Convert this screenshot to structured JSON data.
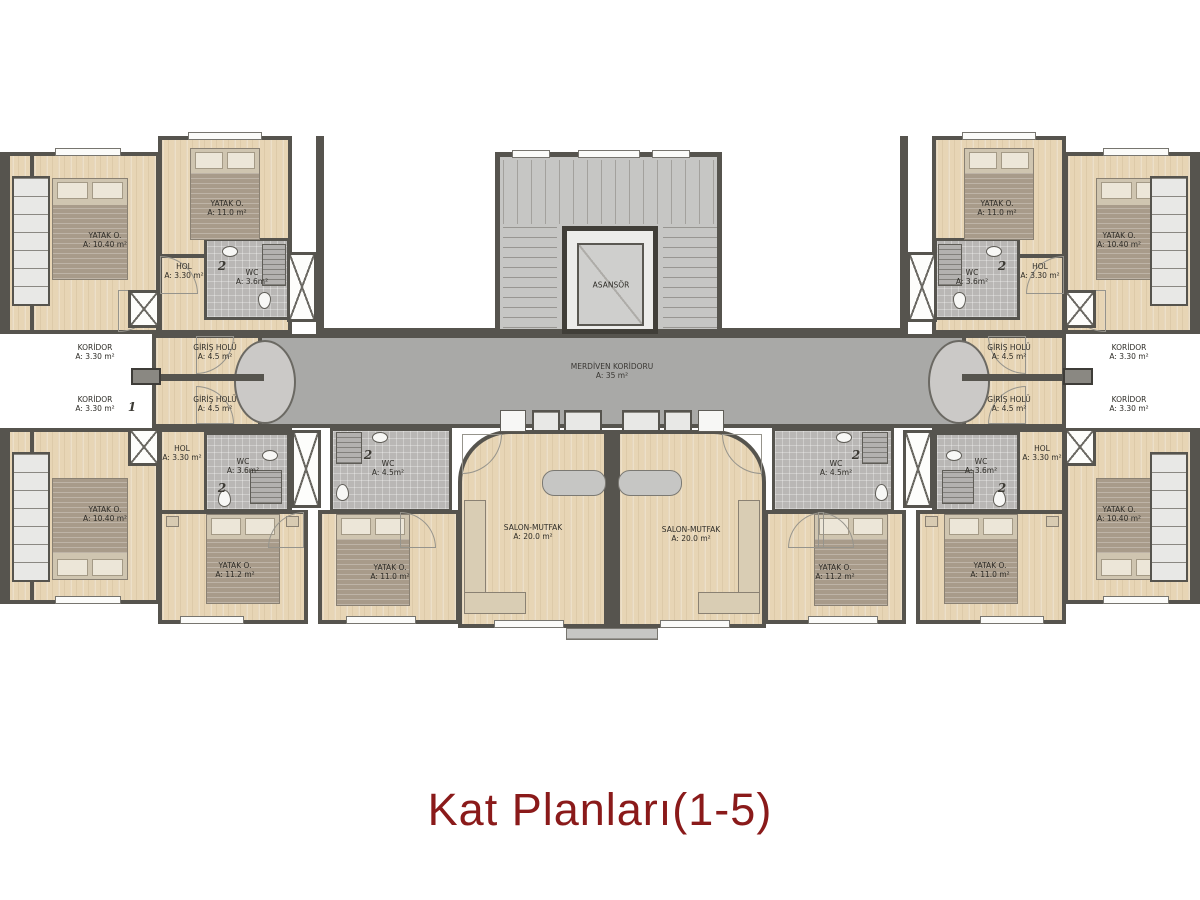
{
  "title": {
    "text": "Kat Planları(1-5)",
    "color": "#8a1a1a"
  },
  "colors": {
    "wall": "#56544e",
    "floor_wood": "#e7d5b5",
    "hall_gray": "#a9a9a7",
    "wc_tile": "#b9b7b5",
    "title": "#8a1a1a"
  },
  "plan": {
    "stair_hall": {
      "name": "MERDİVEN KORİDORU",
      "area": "A: 35 m²"
    },
    "elevator_label": "ASANSÖR",
    "salon_left": {
      "name": "SALON-MUTFAK",
      "area": "A: 20.0 m²"
    },
    "salon_right": {
      "name": "SALON-MUTFAK",
      "area": "A: 20.0 m²"
    },
    "top_left": {
      "koridor": {
        "name": "KORİDOR",
        "area": "A: 3.30 m²"
      },
      "giris": {
        "name": "GİRİŞ HOLÜ",
        "area": "A: 4.5 m²"
      },
      "hol": {
        "name": "HOL",
        "area": "A: 3.30 m²"
      },
      "wc": {
        "name": "WC",
        "area": "A: 3.6m²",
        "marker": "2"
      },
      "bedroom_corner": {
        "name": "YATAK O.",
        "area": "A: 10.40 m²"
      },
      "bedroom_mid": {
        "name": "YATAK O.",
        "area": "A: 11.0 m²"
      }
    },
    "top_right": {
      "koridor": {
        "name": "KORİDOR",
        "area": "A: 3.30 m²"
      },
      "giris": {
        "name": "GİRİŞ HOLÜ",
        "area": "A: 4.5 m²"
      },
      "hol": {
        "name": "HOL",
        "area": "A: 3.30 m²"
      },
      "wc": {
        "name": "WC",
        "area": "A: 3.6m²",
        "marker": "2"
      },
      "bedroom_corner": {
        "name": "YATAK O.",
        "area": "A: 10.40 m²"
      },
      "bedroom_mid": {
        "name": "YATAK O.",
        "area": "A: 11.0 m²"
      }
    },
    "bottom_left": {
      "koridor": {
        "name": "KORİDOR",
        "area": "A: 3.30 m²",
        "marker": "1"
      },
      "giris": {
        "name": "GİRİŞ HOLÜ",
        "area": "A: 4.5 m²"
      },
      "hol": {
        "name": "HOL",
        "area": "A: 3.30 m²"
      },
      "wc": {
        "name": "WC",
        "area": "A: 3.6m²",
        "marker": "2"
      },
      "wc_big": {
        "name": "WC",
        "area": "A: 4.5m²",
        "marker": "2"
      },
      "bedroom_corner": {
        "name": "YATAK O.",
        "area": "A: 10.40 m²"
      },
      "bedroom_outer": {
        "name": "YATAK O.",
        "area": "A: 11.2 m²"
      },
      "bedroom_inner": {
        "name": "YATAK O.",
        "area": "A: 11.0 m²"
      }
    },
    "bottom_right": {
      "koridor": {
        "name": "KORİDOR",
        "area": "A: 3.30 m²"
      },
      "giris": {
        "name": "GİRİŞ HOLÜ",
        "area": "A: 4.5 m²"
      },
      "hol": {
        "name": "HOL",
        "area": "A: 3.30 m²"
      },
      "wc": {
        "name": "WC",
        "area": "A: 3.6m²",
        "marker": "2"
      },
      "wc_big": {
        "name": "WC",
        "area": "A: 4.5m²",
        "marker": "2"
      },
      "bedroom_corner": {
        "name": "YATAK O.",
        "area": "A: 10.40 m²"
      },
      "bedroom_inner": {
        "name": "YATAK O.",
        "area": "A: 11.2 m²"
      },
      "bedroom_outer": {
        "name": "YATAK O.",
        "area": "A: 11.0 m²"
      }
    }
  }
}
